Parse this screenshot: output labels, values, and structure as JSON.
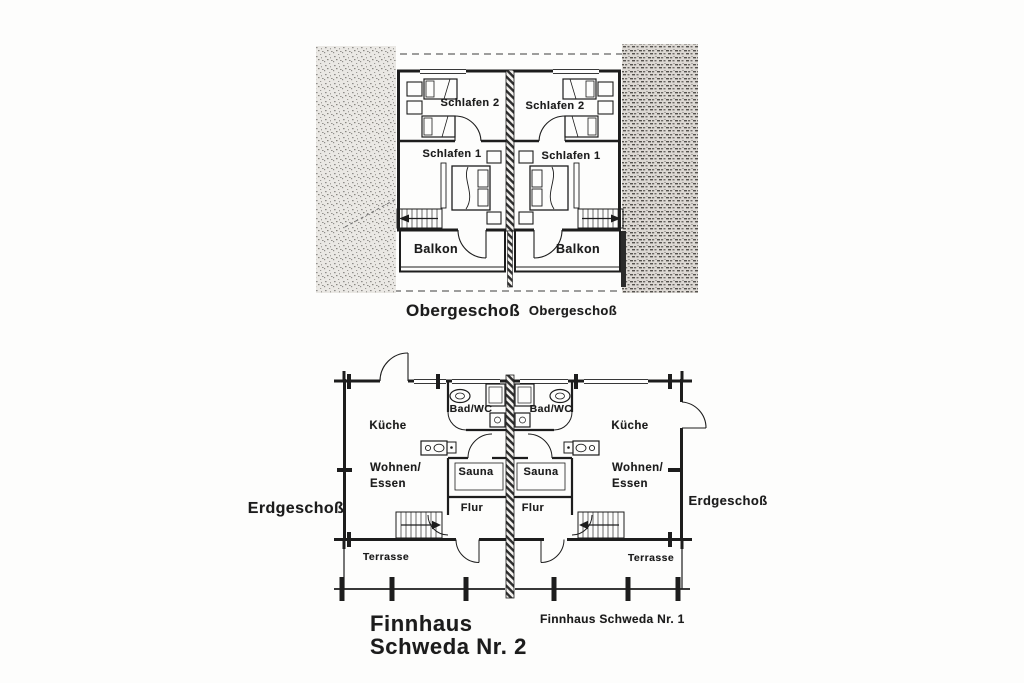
{
  "page": {
    "paper_color": "#fdfdfc",
    "ink_color": "#1d1d1d"
  },
  "upper_floor": {
    "caption_left": "Obergeschoß",
    "caption_right": "Obergeschoß",
    "left_unit": {
      "schlafen2": "Schlafen 2",
      "schlafen1": "Schlafen 1",
      "balkon": "Balkon"
    },
    "right_unit": {
      "schlafen2": "Schlafen 2",
      "schlafen1": "Schlafen 1",
      "balkon": "Balkon"
    }
  },
  "ground_floor": {
    "caption_left": "Erdgeschoß",
    "caption_right": "Erdgeschoß",
    "left_unit": {
      "kueche": "Küche",
      "wohnen": "Wohnen/",
      "essen": "Essen",
      "bad_wc": "Bad/WC",
      "sauna": "Sauna",
      "flur": "Flur",
      "terrasse": "Terrasse"
    },
    "right_unit": {
      "kueche": "Küche",
      "wohnen": "Wohnen/",
      "essen": "Essen",
      "bad_wc": "Bad/WC",
      "sauna": "Sauna",
      "flur": "Flur",
      "terrasse": "Terrasse"
    }
  },
  "titles": {
    "main_line1": "Finnhaus",
    "main_line2": "Schweda Nr. 2",
    "secondary": "Finnhaus Schweda Nr. 1"
  }
}
